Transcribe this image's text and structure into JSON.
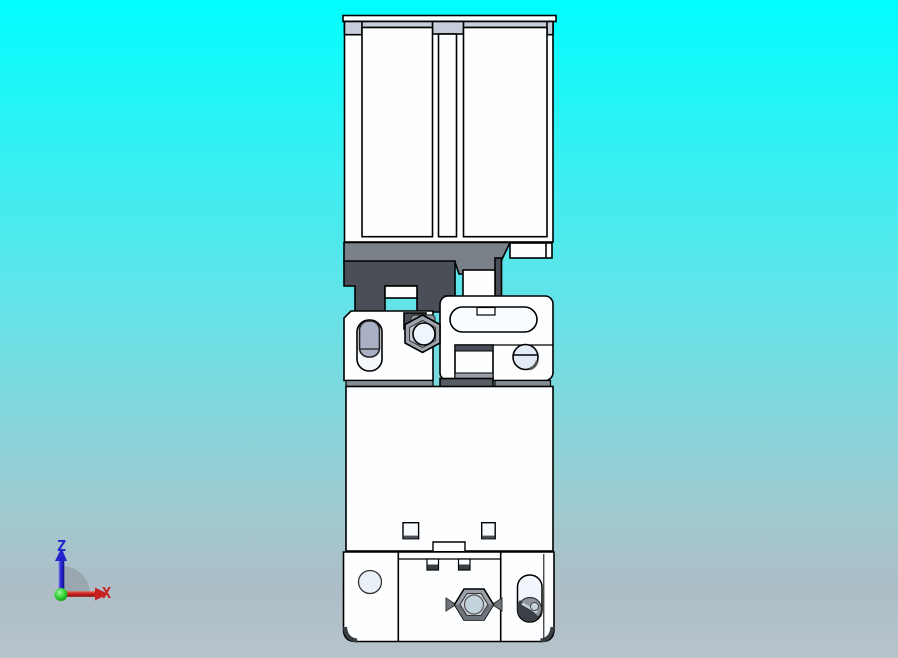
{
  "viewer": {
    "type": "3d-cad-viewport",
    "background": {
      "top": "#01feff",
      "mid": "#63e3e8",
      "bottom": "#b6c3cb"
    }
  },
  "axis_triad": {
    "z_label": "Z",
    "x_label": "X",
    "z_axis_color": "#2323cb",
    "x_axis_color": "#c82020",
    "origin_color": "#2fd22f",
    "sector_color": "#99a4ad"
  },
  "model": {
    "name": "limit-switch-with-mounting-bracket-front-view",
    "outline_color": "#000000",
    "body_color": "#fdfeff",
    "terminal_band_color": "#c5cdda",
    "bracket_dark_color": "#4a4f57",
    "bracket_mid_color": "#7a8088",
    "plunger_color": "#a9b0c4",
    "nut_color": "#9ca3ad",
    "nut_face_color": "#c3cad2",
    "bolt_color": "#9aa0a8",
    "bolt_face_color": "#cbd1d6",
    "bolt_center_color": "#c2d3db",
    "screw_head_color": "#e2ebf5",
    "slot_screw_color": "#8f969e",
    "hole_fill_color": "#e9eff7"
  }
}
